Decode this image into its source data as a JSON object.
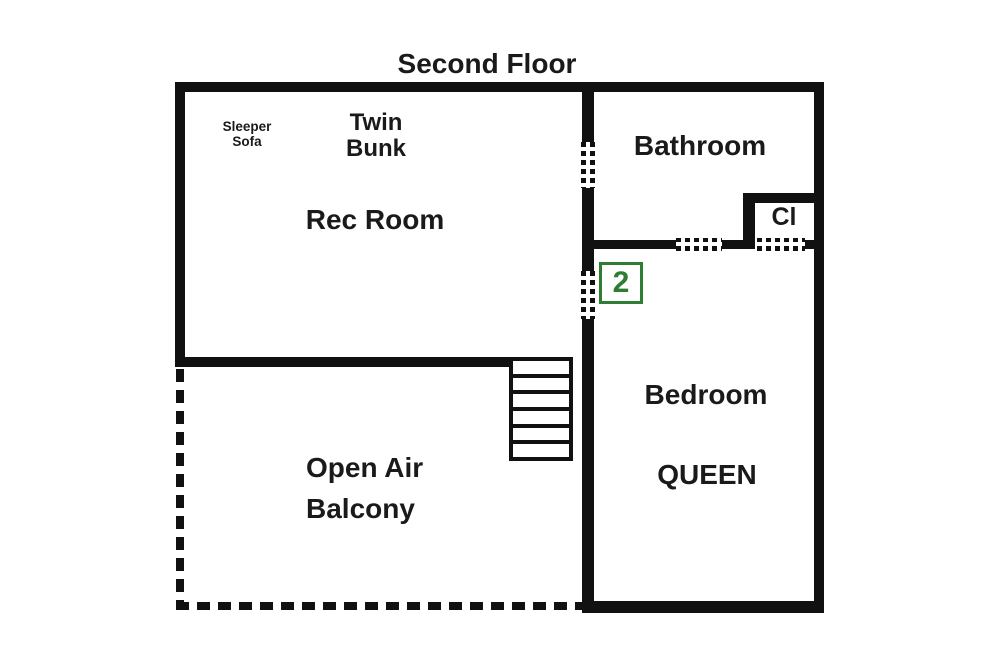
{
  "title": "Second Floor",
  "badge": {
    "number": "2",
    "color": "#2e7d32"
  },
  "rooms": {
    "rec_room": {
      "label": "Rec Room"
    },
    "bathroom": {
      "label": "Bathroom"
    },
    "closet": {
      "label": "Cl"
    },
    "bedroom": {
      "label": "Bedroom",
      "bed_type": "QUEEN"
    },
    "balcony": {
      "label": "Open Air\nBalcony"
    }
  },
  "furniture": {
    "sleeper_sofa": "Sleeper\nSofa",
    "twin_bunk": "Twin\nBunk"
  },
  "stairs": {
    "steps": 6
  },
  "colors": {
    "wall": "#111111",
    "text": "#1a1a1a",
    "badge_green": "#2e7d32",
    "background": "#ffffff"
  }
}
